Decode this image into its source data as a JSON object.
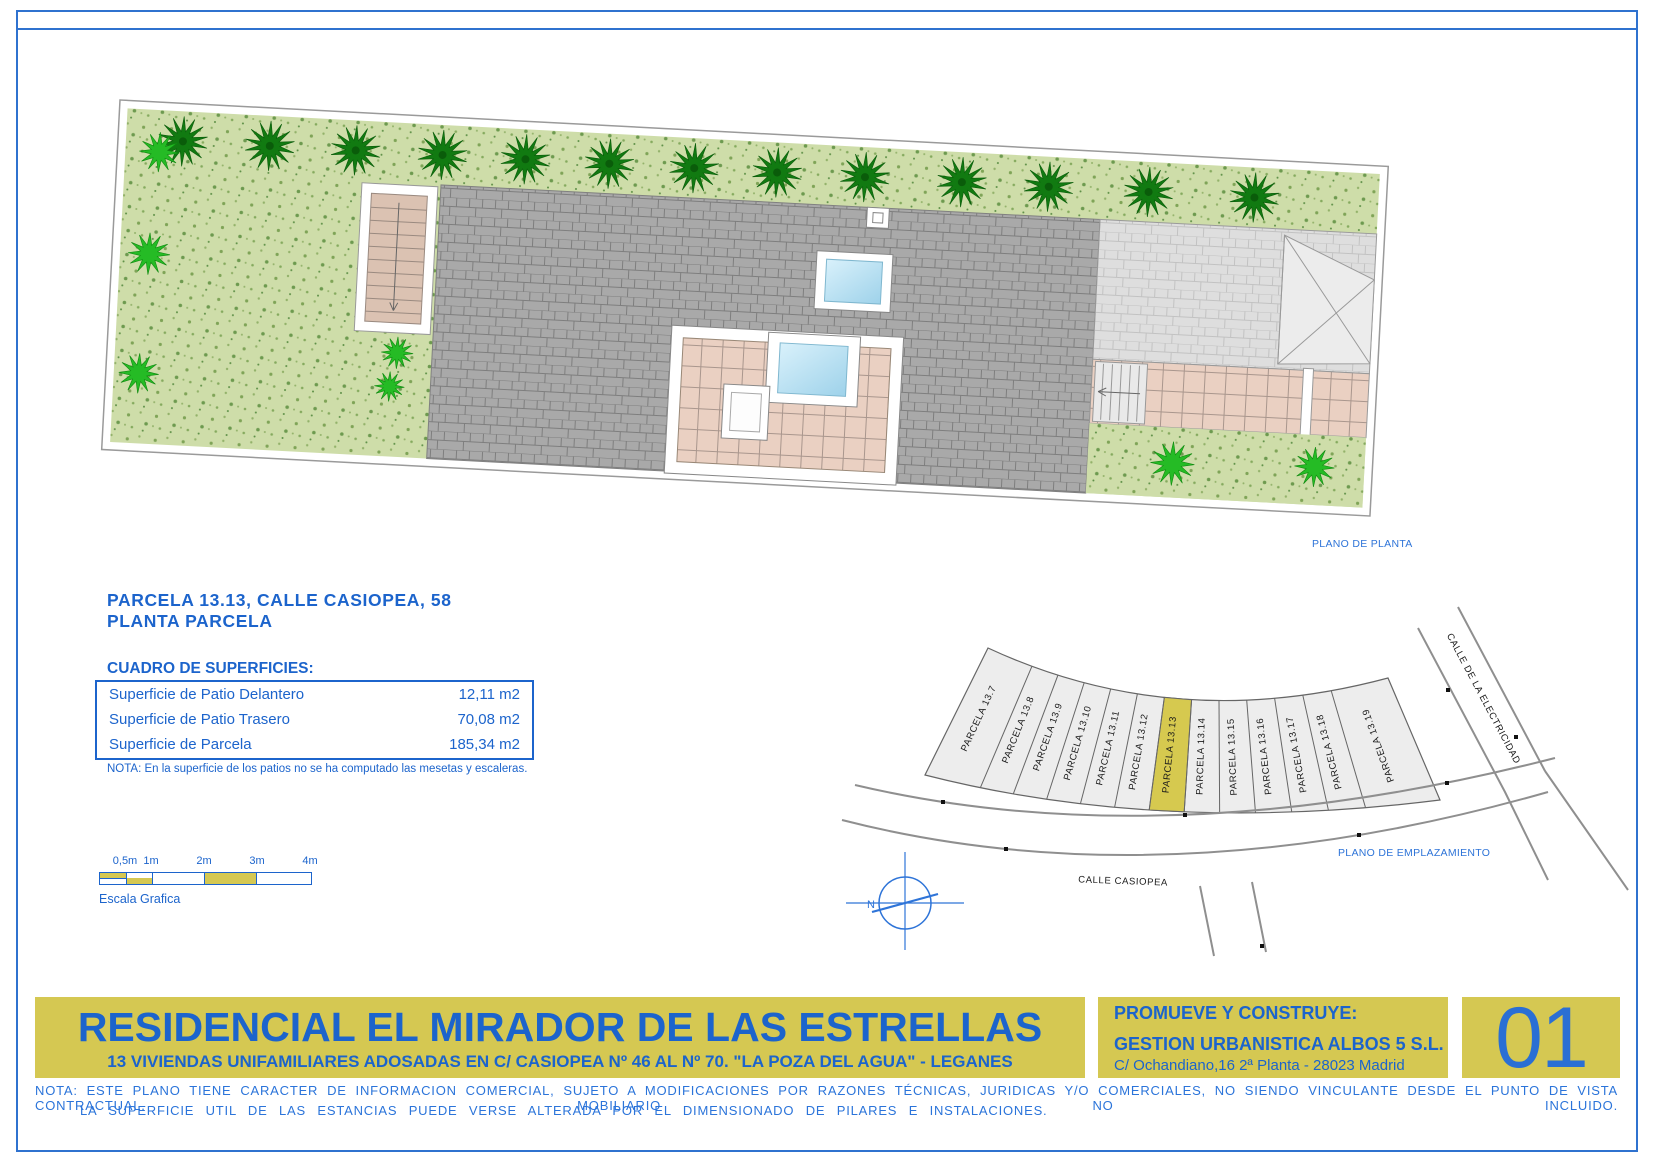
{
  "captions": {
    "plano_planta": "PLANO DE PLANTA",
    "plano_emplazamiento": "PLANO DE EMPLAZAMIENTO"
  },
  "parcel_info": {
    "title_line1": "PARCELA 13.13, CALLE CASIOPEA, 58",
    "title_line2": "PLANTA PARCELA"
  },
  "surfaces": {
    "heading": "CUADRO DE SUPERFICIES:",
    "rows": [
      {
        "label": "Superficie de Patio Delantero",
        "value": "12,11 m2"
      },
      {
        "label": "Superficie de Patio Trasero",
        "value": "70,08 m2"
      },
      {
        "label": "Superficie de Parcela",
        "value": "185,34 m2"
      }
    ],
    "note": "NOTA: En la superficie de los patios no se ha computado las mesetas y escaleras."
  },
  "scale": {
    "labels": [
      "0,5m",
      "1m",
      "2m",
      "3m",
      "4m"
    ],
    "caption": "Escala Grafica"
  },
  "emplazamiento": {
    "parcels": [
      "PARCELA 13.7",
      "PARCELA 13.8",
      "PARCELA 13.9",
      "PARCELA 13.10",
      "PARCELA 13.11",
      "PARCELA 13.12",
      "PARCELA 13.13",
      "PARCELA 13.14",
      "PARCELA 13.15",
      "PARCELA 13.16",
      "PARCELA 13.17",
      "PARCELA 13.18",
      "PARCELA 13.19"
    ],
    "highlighted_parcel": "PARCELA 13.13",
    "highlighted_index": 6,
    "street_main": "CALLE CASIOPEA",
    "street_side": "CALLE DE LA ELECTRICIDAD",
    "north_label": "N"
  },
  "title_block": {
    "project_title": "RESIDENCIAL EL MIRADOR DE LAS ESTRELLAS",
    "project_subtitle": "13 VIVIENDAS UNIFAMILIARES ADOSADAS EN C/ CASIOPEA Nº 46 AL Nº 70. \"LA POZA DEL AGUA\" - LEGANES",
    "promoter_heading": "PROMUEVE Y CONSTRUYE:",
    "promoter_name": "GESTION URBANISTICA ALBOS 5 S.L.",
    "promoter_address": "C/ Ochandiano,16 2ª Planta - 28023 Madrid",
    "sheet_number": "01"
  },
  "footer_note": {
    "line1": "NOTA: ESTE PLANO TIENE CARACTER DE INFORMACION COMERCIAL, SUJETO A MODIFICACIONES POR RAZONES TÉCNICAS, JURIDICAS Y/O COMERCIALES, NO SIENDO VINCULANTE DESDE EL PUNTO DE VISTA CONTRACTUAL. MOBILIARIO NO INCLUIDO.",
    "line2": "LA SUPERFICIE UTIL DE LAS ESTANCIAS PUEDE VERSE ALTERADA POR EL DIMENSIONADO DE PILARES E INSTALACIONES."
  },
  "colors": {
    "accent_blue": "#1c64cc",
    "band_yellow": "#d5c852",
    "highlight_yellow": "#d6c94f",
    "garden_green": "#cedda9",
    "roof_gray": "#a9a9a9",
    "patio_pink": "#ead0c2"
  }
}
